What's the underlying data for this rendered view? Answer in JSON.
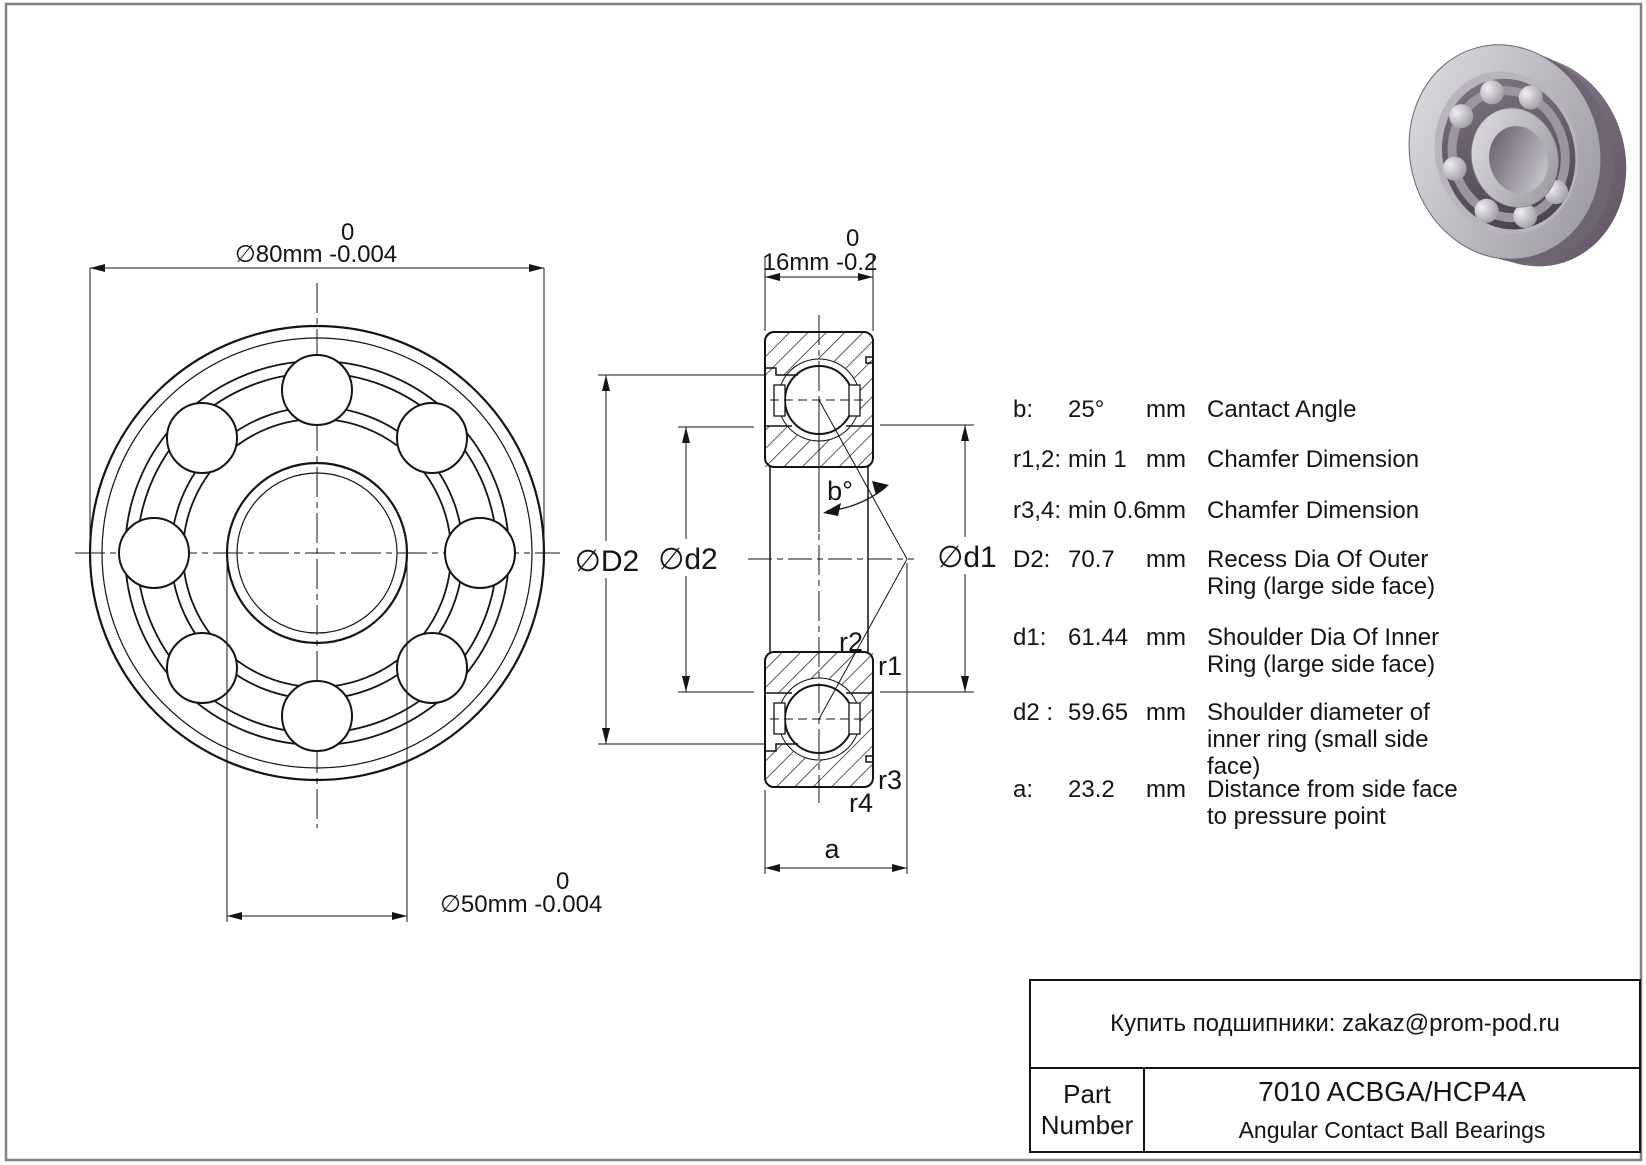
{
  "front_view": {
    "dim_od": {
      "upper": "0",
      "text": "∅80mm -0.004"
    },
    "dim_bore": {
      "upper": "0",
      "text": "∅50mm -0.004"
    }
  },
  "section_view": {
    "dim_width": {
      "upper": "0",
      "text": "16mm -0.2"
    },
    "labels": {
      "D2": "∅D2",
      "d2": "∅d2",
      "d1": "∅d1",
      "b": "b°",
      "r1": "r1",
      "r2": "r2",
      "r3": "r3",
      "r4": "r4",
      "a": "a"
    }
  },
  "specs": {
    "rows": [
      {
        "label": "b:",
        "value": "25°",
        "unit": "mm",
        "desc": "Cantact Angle"
      },
      {
        "label": "r1,2:",
        "value": "min 1",
        "unit": "mm",
        "desc": "Chamfer Dimension"
      },
      {
        "label": "r3,4:",
        "value": "min 0.6",
        "unit": "mm",
        "desc": "Chamfer Dimension"
      },
      {
        "label": "D2:",
        "value": "70.7",
        "unit": "mm",
        "desc": "Recess Dia Of Outer Ring (large side face)"
      },
      {
        "label": "d1:",
        "value": "61.44",
        "unit": "mm",
        "desc": "Shoulder Dia Of Inner Ring (large side face)"
      },
      {
        "label": "d2 :",
        "value": "59.65",
        "unit": "mm",
        "desc": "Shoulder diameter of inner ring (small side face)"
      },
      {
        "label": "a:",
        "value": "23.2",
        "unit": "mm",
        "desc": "Distance from side face to pressure point"
      }
    ]
  },
  "title_block": {
    "contact": "Купить подшипники: zakaz@prom-pod.ru",
    "part_label": "Part Number",
    "part_number": "7010 ACBGA/HCP4A",
    "category": "Angular Contact Ball Bearings"
  }
}
